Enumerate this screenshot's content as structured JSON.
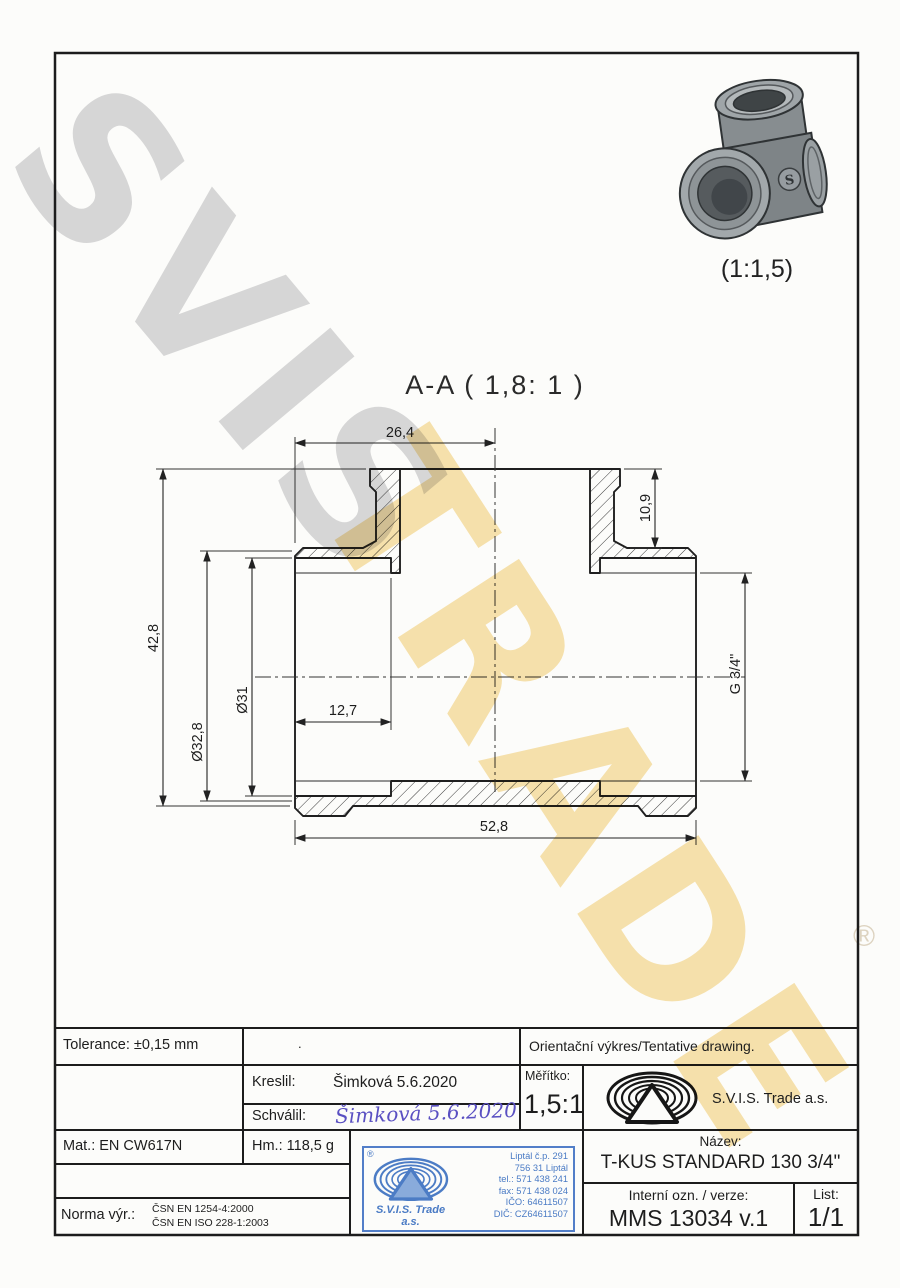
{
  "watermark": {
    "word1": "SVIS",
    "word2": "TRADE",
    "registered": "®",
    "grey": "#d6d6d6",
    "yellow": "#f6dc9b"
  },
  "photo": {
    "caption": "(1:1,5)",
    "badge_letter": "S"
  },
  "section_view": {
    "title": "A-A ( 1,8: 1 )",
    "dimensions": {
      "top_width": "26,4",
      "branch_depth": "10,9",
      "overall_height": "42,8",
      "outer_dia": "Ø32,8",
      "bore_dia": "Ø31",
      "thread_depth": "12,7",
      "thread_size": "G 3/4\"",
      "overall_length": "52,8"
    }
  },
  "title_block": {
    "tolerance": "Tolerance: ±0,15 mm",
    "middle_dot": ".",
    "orientacni": "Orientační výkres/Tentative drawing.",
    "kreslil_label": "Kreslil:",
    "kreslil_value": "Šimková 5.6.2020",
    "schvalil_label": "Schválil:",
    "schvalil_value": "Šimková 5.6.2020",
    "meritko_label": "Měřítko:",
    "meritko_value": "1,5:1",
    "company": "S.V.I.S. Trade a.s.",
    "mat": "Mat.: EN CW617N",
    "hm": "Hm.: 118,5 g",
    "norma_label": "Norma výr.:",
    "norma_line1": "ČSN EN 1254-4:2000",
    "norma_line2": "ČSN EN ISO 228-1:2003",
    "nazev_label": "Název:",
    "nazev_value": "T-KUS STANDARD 130 3/4\"",
    "interni_label": "Interní ozn. / verze:",
    "interni_value": "MMS 13034 v.1",
    "list_label": "List:",
    "list_value": "1/1"
  },
  "stamp": {
    "registered": "®",
    "company_line1": "S.V.I.S. Trade",
    "company_line2": "a.s.",
    "address": [
      "Liptál č.p. 291",
      "756 31 Liptál",
      "tel.: 571 438 241",
      "fax: 571 438 024",
      "IČO: 64611507",
      "DIČ: CZ64611507"
    ],
    "blue": "#3a6fc0"
  },
  "colors": {
    "line": "#222222",
    "signature_blue": "#5a50c2",
    "paper": "#fcfcfa"
  }
}
